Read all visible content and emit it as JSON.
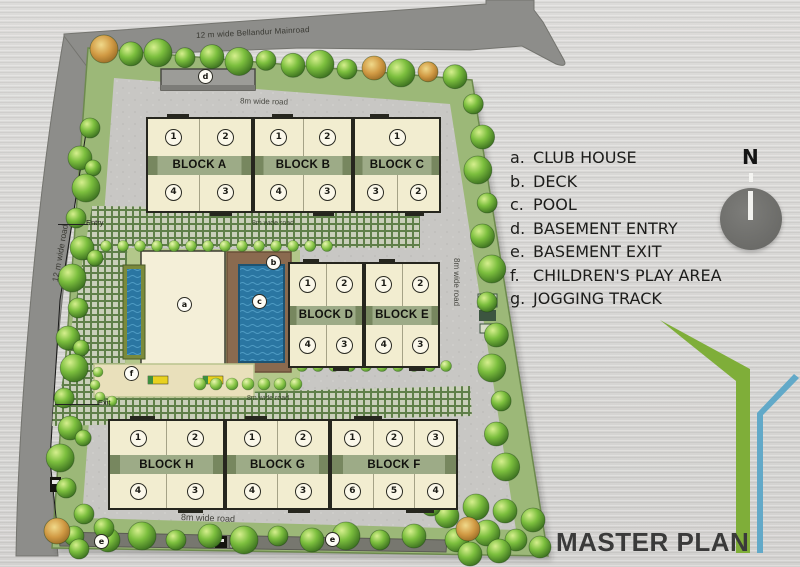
{
  "title": "MASTER PLAN",
  "compass": {
    "label": "N"
  },
  "legend": {
    "items": [
      {
        "key": "a.",
        "label": "CLUB HOUSE",
        "name": "legend-club-house"
      },
      {
        "key": "b.",
        "label": "DECK",
        "name": "legend-deck"
      },
      {
        "key": "c.",
        "label": "POOL",
        "name": "legend-pool"
      },
      {
        "key": "d.",
        "label": "BASEMENT ENTRY",
        "name": "legend-basement-entry"
      },
      {
        "key": "e.",
        "label": "BASEMENT EXIT",
        "name": "legend-basement-exit"
      },
      {
        "key": "f.",
        "label": "CHILDREN'S PLAY AREA",
        "name": "legend-childrens-play-area"
      },
      {
        "key": "g.",
        "label": "JOGGING TRACK",
        "name": "legend-jogging-track"
      }
    ]
  },
  "roads": {
    "main_road": "12 m wide Bellandur Mainroad",
    "left_road": "12 m wide road",
    "right_road": "8m wide road",
    "top_inner_road": "8m wide road",
    "mid_upper_road": "8m wide road",
    "mid_lower_road": "8m wide road",
    "bottom_inner_road": "8m wide road",
    "entry": "Entry",
    "exit": "Exit"
  },
  "plan_markers": [
    {
      "label": "a",
      "name": "marker-club-house"
    },
    {
      "label": "b",
      "name": "marker-deck"
    },
    {
      "label": "c",
      "name": "marker-pool"
    },
    {
      "label": "d",
      "name": "marker-basement-entry"
    },
    {
      "label": "f",
      "name": "marker-childrens-play-area"
    },
    {
      "label": "e",
      "name": "marker-basement-exit-left"
    },
    {
      "label": "e",
      "name": "marker-basement-exit-right"
    }
  ],
  "block_rows": [
    {
      "blocks": [
        {
          "name": "BLOCK A",
          "top": [
            "1",
            "2"
          ],
          "bottom": [
            "4",
            "3"
          ]
        },
        {
          "name": "BLOCK B",
          "top": [
            "1",
            "2"
          ],
          "bottom": [
            "4",
            "3"
          ]
        },
        {
          "name": "BLOCK C",
          "top": [
            "1"
          ],
          "bottom": [
            "3",
            "2"
          ]
        }
      ]
    },
    {
      "blocks": [
        {
          "name": "BLOCK D",
          "top": [
            "1",
            "2"
          ],
          "bottom": [
            "4",
            "3"
          ]
        },
        {
          "name": "BLOCK E",
          "top": [
            "1",
            "2"
          ],
          "bottom": [
            "4",
            "3"
          ]
        }
      ]
    },
    {
      "blocks": [
        {
          "name": "BLOCK H",
          "top": [
            "1",
            "2"
          ],
          "bottom": [
            "4",
            "3"
          ]
        },
        {
          "name": "BLOCK G",
          "top": [
            "1",
            "2"
          ],
          "bottom": [
            "4",
            "3"
          ]
        },
        {
          "name": "BLOCK F",
          "top": [
            "1",
            "2",
            "3"
          ],
          "bottom": [
            "6",
            "5",
            "4"
          ]
        }
      ]
    }
  ],
  "colors": {
    "accent_green": "#7fae39",
    "accent_blue": "#62a9c8",
    "road_gray": "#8d8d8a",
    "building_cream": "#f2edd0",
    "pool_blue": "#2a76a2",
    "deck_brown": "#8a6a4f",
    "hatch_green": "#5f7f49"
  }
}
